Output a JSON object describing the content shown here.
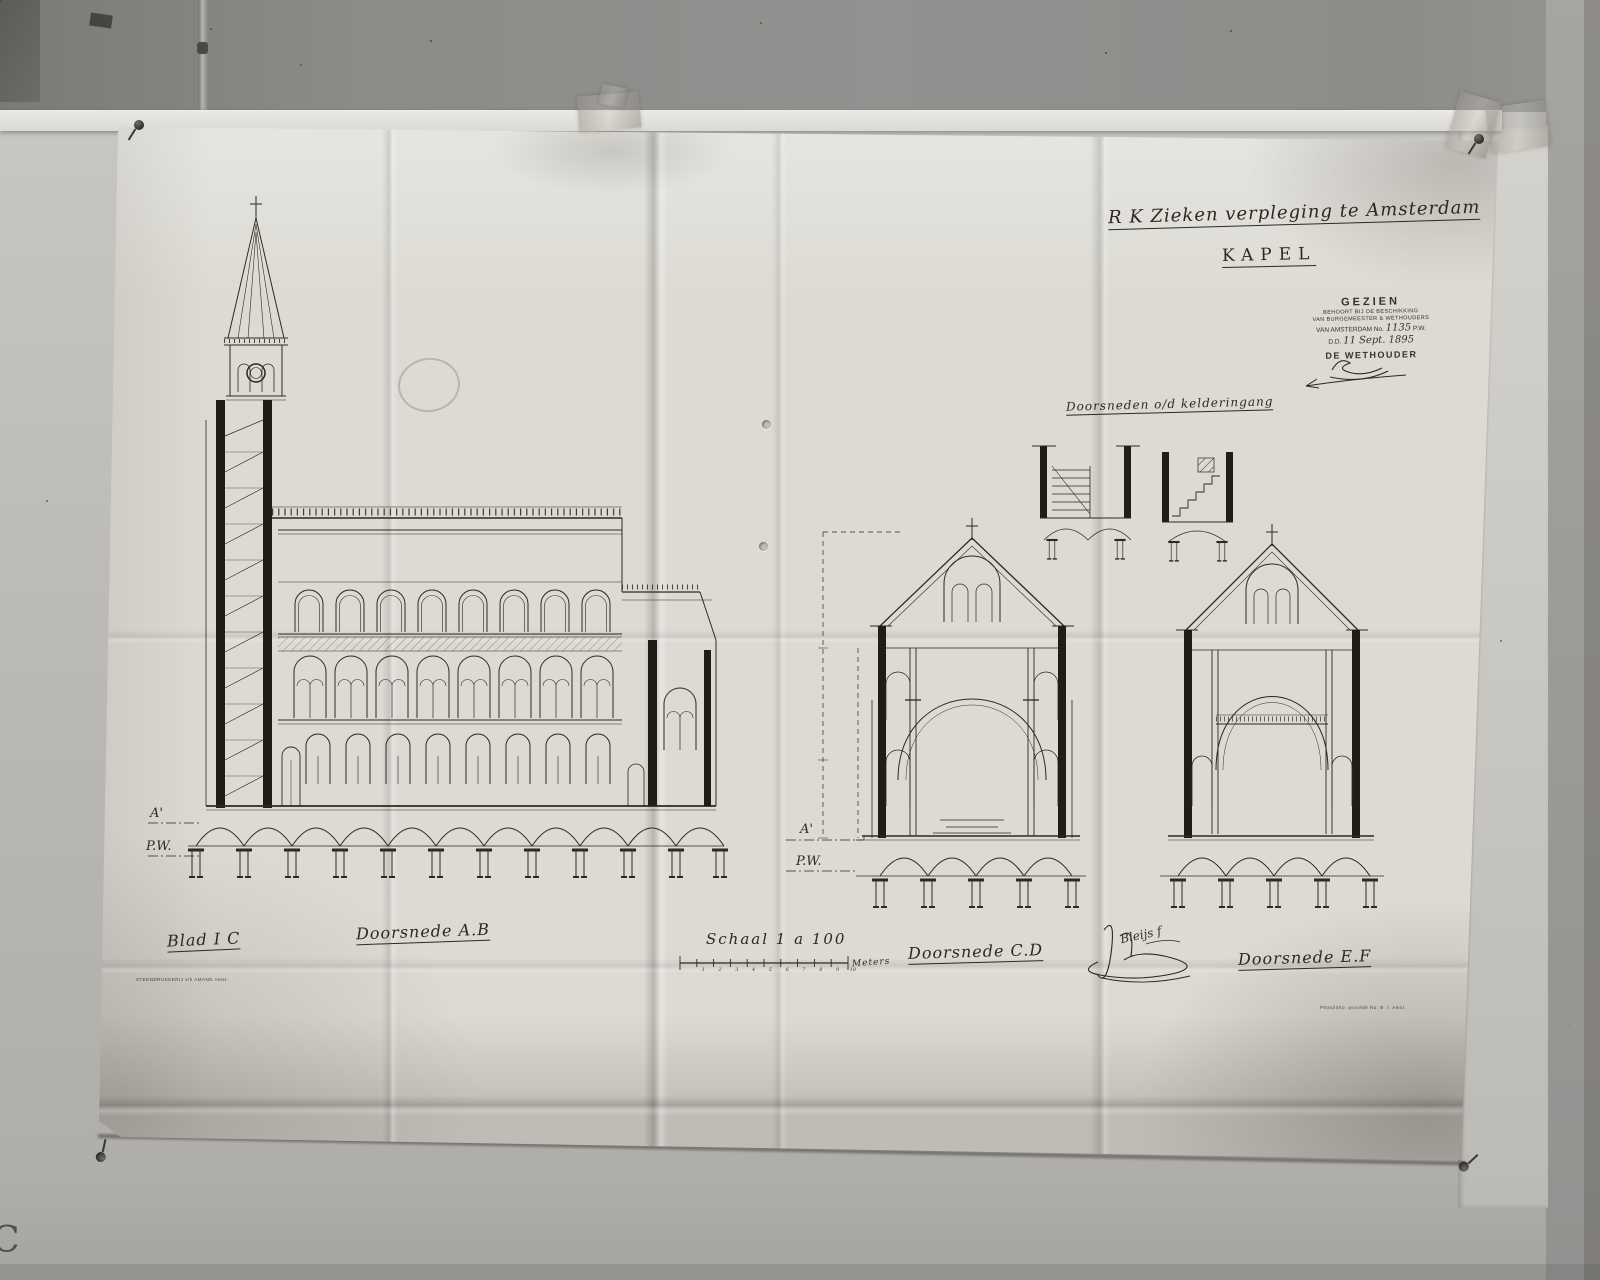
{
  "title": {
    "institution": "R K Zieken verpleging te Amsterdam",
    "subject": "KAPEL"
  },
  "stamp": {
    "heading": "GEZIEN",
    "line2": "BEHOORT BIJ DE BESCHIKKING",
    "line3": "VAN BURGEMEESTER & WETHOUDERS",
    "line4_prefix": "VAN AMSTERDAM No.",
    "document_number": "1135",
    "line4_suffix": "P.W.",
    "date_prefix": "D.D.",
    "date": "11 Sept. 1895",
    "signer_title": "DE WETHOUDER"
  },
  "labels": {
    "kelderingang": "Doorsneden o/d kelderingang",
    "blad": "Blad I C",
    "doorsnede_ab": "Doorsnede A.B",
    "doorsnede_cd": "Doorsnede C.D",
    "doorsnede_ef": "Doorsnede E.F"
  },
  "scale": {
    "label": "Schaal 1 a 100",
    "unit": "Meters",
    "ticks": [
      "1",
      "2",
      "3",
      "4",
      "5",
      "6",
      "7",
      "8",
      "9",
      "10"
    ]
  },
  "datum": {
    "a_line": "A'",
    "water_line": "P.W."
  },
  "signature": {
    "architect": "Bleijs f"
  },
  "imprints": {
    "printer": "STEENDRUKKERIJ v/h AMAND Amst.",
    "photolitho": "Photolitho. procédé No. B. I. Amst."
  },
  "photo_mark": "C"
}
